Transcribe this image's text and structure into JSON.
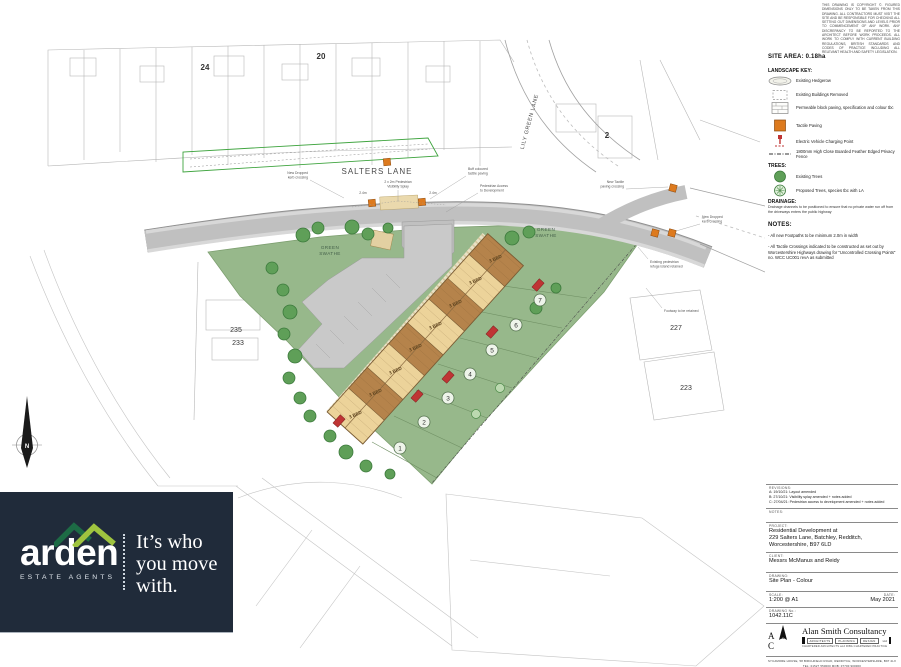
{
  "plan": {
    "streets": {
      "salters": "SALTERS LANE",
      "lily_green": "LILY GREEN LANE"
    },
    "green_swathe": {
      "line1": "GREEN",
      "line2": "SWATHE"
    },
    "house_numbers": {
      "n24": "24",
      "n20": "20",
      "n2": "2",
      "n235": "235",
      "n233": "233",
      "n227": "227",
      "n223": "223"
    },
    "plots": [
      "1",
      "2",
      "3",
      "4",
      "5",
      "6",
      "7"
    ],
    "bed_label": "3 BED",
    "north": "N",
    "annotations": {
      "dropped_kerb_w1": "New Dropped",
      "dropped_kerb_w2": "kerb crossing",
      "vis_splay1": "2 x 2m Pedestrian",
      "vis_splay2": "Visibility Splay",
      "dim_left": "2.4m",
      "dim_right": "2.4m",
      "tactile1": "Buff coloured",
      "tactile2": "tactile paving",
      "ped_access1": "Pedestrian Access",
      "ped_access2": "to Development",
      "new_tactile1": "New Tactile",
      "new_tactile2": "paving crossing",
      "dropped_kerb_e1": "New Dropped",
      "dropped_kerb_e2": "kerb crossing",
      "refuge1": "Existing pedestrian",
      "refuge2": "refuge island retained",
      "footway": "Footway to be retained"
    }
  },
  "side_panel": {
    "copyright": "THIS DRAWING IS COPYRIGHT ©. FIGURED DIMENSIONS ONLY TO BE TAKEN FROM THIS DRAWING. ALL CONTRACTORS MUST VISIT THE SITE AND BE RESPONSIBLE FOR CHECKING ALL SETTING OUT DIMENSIONS AND LEVELS PRIOR TO COMMENCEMENT OF ANY WORK. ANY DISCREPANCY TO BE REPORTED TO THE ARCHITECT BEFORE WORK PROCEEDS. ALL WORK TO COMPLY WITH CURRENT BUILDING REGULATIONS, BRITISH STANDARDS AND CODES OF PRACTICE INCLUDING ALL RELEVANT HEALTH AND SAFETY LEGISLATION.",
    "site_area": "SITE AREA: 0.18ha",
    "landscape_key_title": "LANDSCAPE KEY:",
    "key_items": [
      "Existing Hedgerow",
      "Existing Buildings Removed",
      "Permeable block paving, specification and colour tbc",
      "Tactile Paving",
      "Electric Vehicle Charging Point",
      "1800mm High Close Boarded Feather Edged Privacy Fence"
    ],
    "trees_title": "TREES:",
    "tree_items": [
      "Existing Trees",
      "Proposed Trees, species tbc with LA"
    ],
    "drainage_title": "DRAINAGE:",
    "drainage_note": "Drainage channels to be positioned to ensure that no private water run off from the driveways enters the public highway",
    "notes_title": "NOTES:",
    "notes": [
      "All new Footpaths to be minimum 2.0m in width",
      "All Tactile Crossings indicated to be constructed as set out by Worcestershire Highways drawing for \"Uncontrolled Crossing Points\" no. WCC UC001 revA as submitted"
    ]
  },
  "title_block": {
    "revisions_label": "REVISIONS:",
    "revisions": [
      "A: 19/10/21: Layout amended",
      "B: 27/10/21: Visibility splay amended + notes added",
      "C: 27/04/21: Pedestrian access to development amended + notes added"
    ],
    "notes_label": "NOTES:",
    "project_label": "PROJECT:",
    "project_lines": [
      "Residential Development at",
      "229 Salters Lane, Batchley, Redditch,",
      "Worcestershire, B97 6LD"
    ],
    "client_label": "CLIENT:",
    "client": "Messrs McManus and Reidy",
    "drawing_label": "DRAWING:",
    "drawing": "Site Plan - Colour",
    "scale_label": "SCALE:",
    "scale": "1:200 @ A1",
    "date_label": "DATE:",
    "date": "May 2021",
    "drawing_no_label": "DRAWING No.:",
    "drawing_no": "1042.11C",
    "firm": {
      "initials": "A S C",
      "name": "Alan Smith Consultancy",
      "disciplines": [
        "ARCHITECTS",
        "PLANNING",
        "DESIGN"
      ],
      "suffix": "Ltd",
      "registration": "CHARTERED ARCHITECTS and RIBA CHARTERED PRACTICE",
      "address": "SYCAMORE HOUSE, 58 BIRCHFIELD ROAD, REDDITCH, WORCESTERSHIRE, B97 4LX",
      "phone": "TEL: 01527 550000   MOB: 07700 900000",
      "email": "EMAIL: info@alansmithconsultancy.co.uk"
    }
  },
  "branding": {
    "logo": "arden",
    "logo_sub": "ESTATE AGENTS",
    "tagline_lines": [
      "It’s who",
      "you move",
      "with."
    ]
  }
}
